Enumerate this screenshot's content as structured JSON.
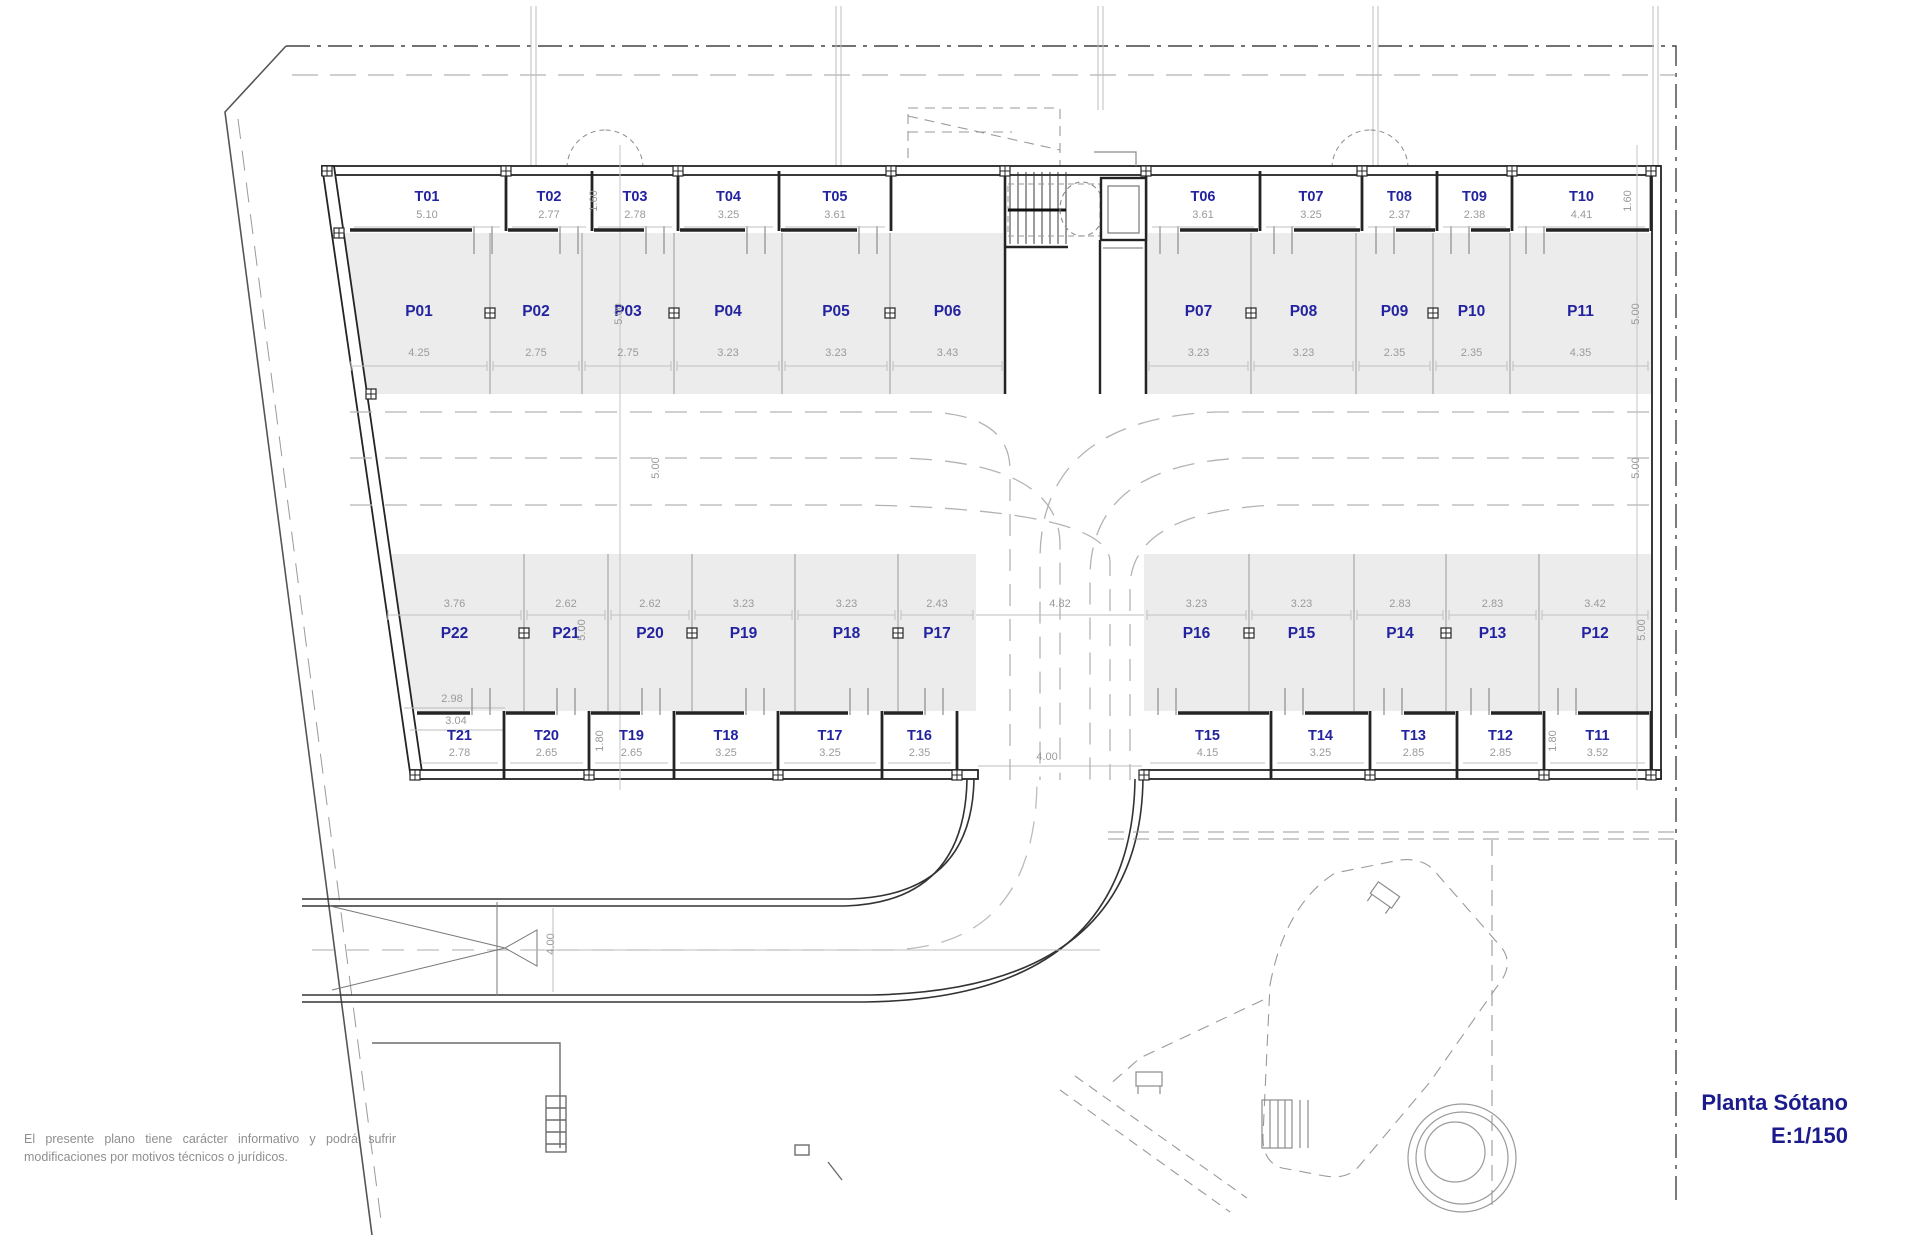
{
  "plan": {
    "title_line1": "Planta Sótano",
    "title_line2": "E:1/150",
    "disclaimer": "El presente plano tiene carácter informativo y podrá sufrir modificaciones por motivos técnicos o jurídicos.",
    "colors": {
      "label_blue": "#2323a0",
      "dim_gray": "#9a9a9a",
      "wall_dark": "#2b2b2b",
      "stall_fill": "#ececec",
      "title_navy": "#1b1b8e"
    },
    "top_trasteros": [
      {
        "id": "T01",
        "dim": "5.10"
      },
      {
        "id": "T02",
        "dim": "2.77"
      },
      {
        "id": "T03",
        "dim": "2.78"
      },
      {
        "id": "T04",
        "dim": "3.25"
      },
      {
        "id": "T05",
        "dim": "3.61"
      },
      {
        "id": "T06",
        "dim": "3.61"
      },
      {
        "id": "T07",
        "dim": "3.25"
      },
      {
        "id": "T08",
        "dim": "2.37"
      },
      {
        "id": "T09",
        "dim": "2.38"
      },
      {
        "id": "T10",
        "dim": "4.41"
      }
    ],
    "top_parkings": [
      {
        "id": "P01",
        "dim": "4.25"
      },
      {
        "id": "P02",
        "dim": "2.75"
      },
      {
        "id": "P03",
        "dim": "2.75"
      },
      {
        "id": "P04",
        "dim": "3.23"
      },
      {
        "id": "P05",
        "dim": "3.23"
      },
      {
        "id": "P06",
        "dim": "3.43"
      },
      {
        "id": "P07",
        "dim": "3.23"
      },
      {
        "id": "P08",
        "dim": "3.23"
      },
      {
        "id": "P09",
        "dim": "2.35"
      },
      {
        "id": "P10",
        "dim": "2.35"
      },
      {
        "id": "P11",
        "dim": "4.35"
      }
    ],
    "bottom_parkings": [
      {
        "id": "P22",
        "dim": "3.76"
      },
      {
        "id": "P21",
        "dim": "2.62"
      },
      {
        "id": "P20",
        "dim": "2.62"
      },
      {
        "id": "P19",
        "dim": "3.23"
      },
      {
        "id": "P18",
        "dim": "3.23"
      },
      {
        "id": "P17",
        "dim": "2.43"
      },
      {
        "id": "P16",
        "dim": "3.23"
      },
      {
        "id": "P15",
        "dim": "3.23"
      },
      {
        "id": "P14",
        "dim": "2.83"
      },
      {
        "id": "P13",
        "dim": "2.83"
      },
      {
        "id": "P12",
        "dim": "3.42"
      }
    ],
    "bottom_trasteros": [
      {
        "id": "T21",
        "dim": "2.78"
      },
      {
        "id": "T20",
        "dim": "2.65"
      },
      {
        "id": "T19",
        "dim": "2.65"
      },
      {
        "id": "T18",
        "dim": "3.25"
      },
      {
        "id": "T17",
        "dim": "3.25"
      },
      {
        "id": "T16",
        "dim": "2.35"
      },
      {
        "id": "T15",
        "dim": "4.15"
      },
      {
        "id": "T14",
        "dim": "3.25"
      },
      {
        "id": "T13",
        "dim": "2.85"
      },
      {
        "id": "T12",
        "dim": "2.85"
      },
      {
        "id": "T11",
        "dim": "3.52"
      }
    ],
    "annotations": {
      "t_height_top_left": "1.60",
      "t_height_top_right": "1.60",
      "p_depth_top_left": "5.00",
      "p_depth_top_right": "5.00",
      "aisle_left": "5.00",
      "aisle_right": "5.00",
      "p_depth_bottom_left": "5.00",
      "p_depth_bottom_right": "5.00",
      "t_height_bottom_left": "1.80",
      "t_height_bottom_right": "1.80",
      "lane_width": "4.82",
      "exit_width": "4.00",
      "ramp_width": "4.00",
      "p22_upper": "2.98",
      "p22_lower": "3.04"
    }
  }
}
